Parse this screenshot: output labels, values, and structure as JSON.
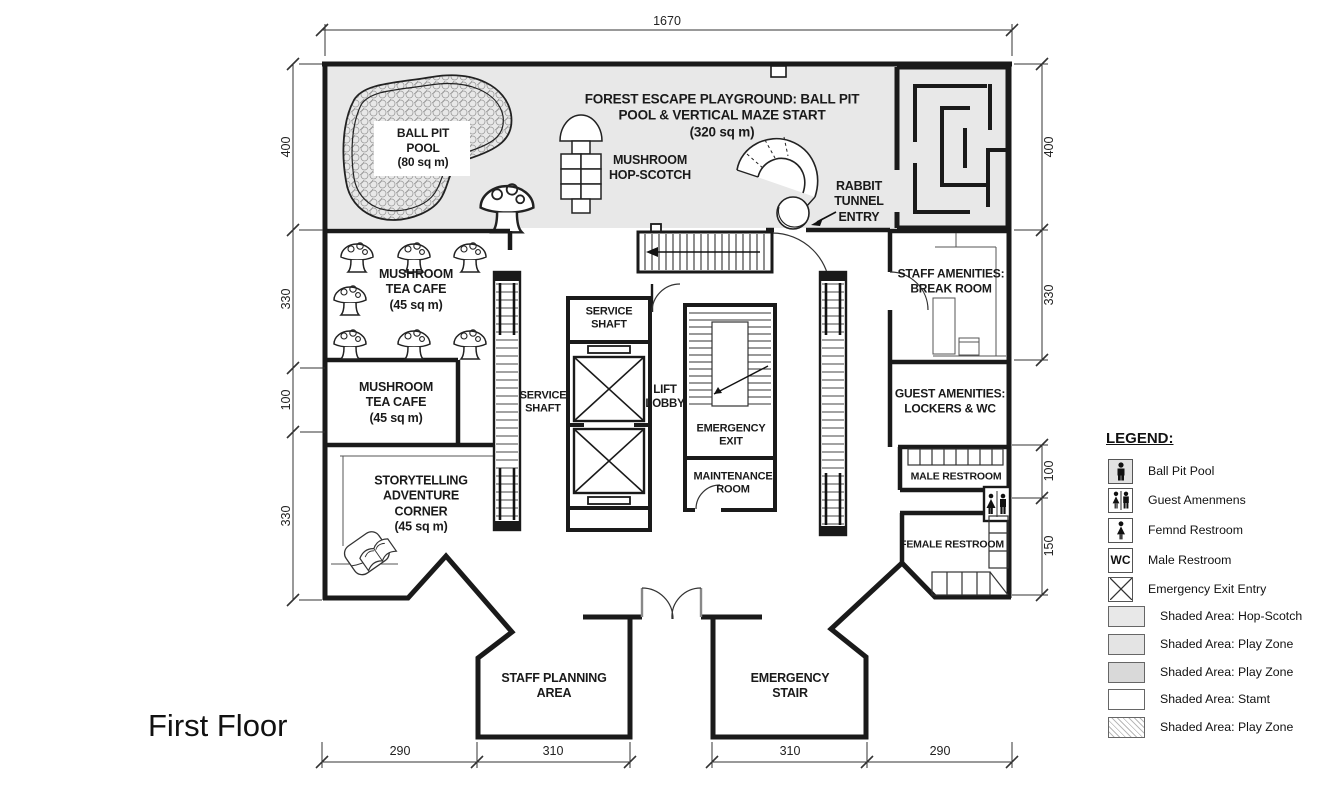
{
  "floor_title": "First Floor",
  "rooms": {
    "playground_title": "FOREST ESCAPE PLAYGROUND: BALL PIT\nPOOL & VERTICAL MAZE START\n(320 sq m)",
    "ball_pit_pool": "BALL PIT\nPOOL\n(80 sq m)",
    "hop_scotch": "MUSHROOM\nHOP-SCOTCH",
    "rabbit_tunnel": "RABBIT\nTUNNEL\nENTRY",
    "cafe_upper": "MUSHROOM\nTEA CAFE\n(45 sq m)",
    "cafe_lower": "MUSHROOM\nTEA CAFE\n(45 sq m)",
    "storytelling": "STORYTELLING\nADVENTURE\nCORNER\n(45 sq m)",
    "service_shaft_escalator": "SERVICE\nSHAFT",
    "service_shaft_lift": "SERVICE\nSHAFT",
    "lift_lobby": "LIFT\nLOBBY",
    "emergency_exit": "EMERGENCY\nEXIT",
    "maintenance_room": "MAINTENANCE\nROOM",
    "staff_amenities": "STAFF AMENITIES:\nBREAK ROOM",
    "guest_amenities": "GUEST AMENITIES:\nLOCKERS & WC",
    "male_restroom": "MALE RESTROOM",
    "female_restroom": "FEMALE RESTROOM",
    "staff_planning": "STAFF PLANNING\nAREA",
    "emergency_stair": "EMERGENCY\nSTAIR"
  },
  "dimensions": {
    "top": "1670",
    "left": [
      "400",
      "330",
      "100",
      "330"
    ],
    "right": [
      "400",
      "330",
      "100",
      "150"
    ],
    "bottom": [
      "290",
      "310",
      "310",
      "290"
    ]
  },
  "legend": {
    "title": "LEGEND:",
    "items": [
      {
        "icon": "male-figure-icon",
        "label": "Ball Pit Pool"
      },
      {
        "icon": "male-female-figures-icon",
        "label": "Guest Amenmens"
      },
      {
        "icon": "female-figure-icon",
        "label": "Femnd Restroom"
      },
      {
        "icon": "wc-icon",
        "label": "Male Restroom"
      },
      {
        "icon": "crossed-box-icon",
        "label": "Emergency Exit Entry"
      },
      {
        "icon": "swatch",
        "swatch": "#e8e8e8",
        "label": "Shaded Area: Hop-Scotch"
      },
      {
        "icon": "swatch",
        "swatch": "#e4e4e4",
        "label": "Shaded Area: Play Zone"
      },
      {
        "icon": "swatch",
        "swatch": "#d9d9d9",
        "label": "Shaded Area: Play Zone"
      },
      {
        "icon": "swatch",
        "swatch": "#ffffff",
        "label": "Shaded Area: Stamt"
      },
      {
        "icon": "swatch",
        "swatch": "hatch-45deg",
        "label": "Shaded Area: Play Zone"
      }
    ]
  },
  "colors": {
    "wall": "#1a1a1a",
    "shaded_play_area": "#e8e8e8",
    "thin_line": "#555555"
  }
}
